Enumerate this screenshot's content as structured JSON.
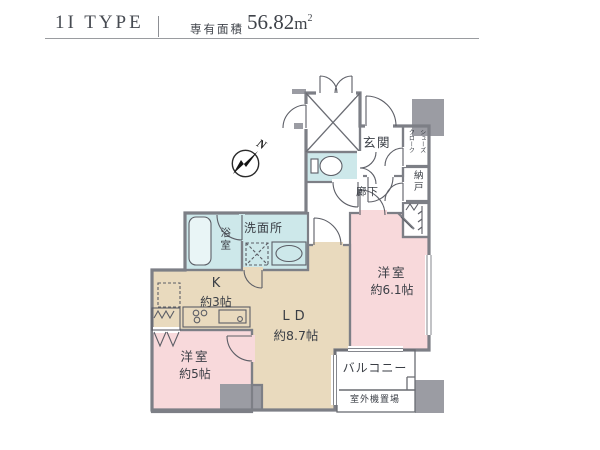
{
  "header": {
    "type_name": "1I TYPE",
    "area_label": "専有面積",
    "area_value": "56.82",
    "area_unit": "m",
    "area_unit_exp": "2"
  },
  "compass": {
    "north": "N"
  },
  "rooms": {
    "entrance": {
      "label": "玄関"
    },
    "shoe_closet": {
      "label": "シューズ\nクローク"
    },
    "storage": {
      "label": "納戸"
    },
    "hallway": {
      "label": "廊下"
    },
    "bathroom": {
      "label": "浴室"
    },
    "washroom": {
      "label": "洗面所"
    },
    "kitchen": {
      "label": "K",
      "size": "約3帖"
    },
    "living_dining": {
      "label": "LD",
      "size": "約8.7帖"
    },
    "bedroom_right": {
      "label": "洋室",
      "size": "約6.1帖"
    },
    "bedroom_left": {
      "label": "洋室",
      "size": "約5帖"
    },
    "balcony": {
      "label": "バルコニー"
    },
    "outdoor_unit": {
      "label": "室外機置場"
    }
  },
  "colors": {
    "bedroom_pink": "#f8d9db",
    "living_tan": "#e9dabe",
    "wet_area_blue": "#cde8ea",
    "common_gray": "#9b9ca3",
    "wall_gray": "#7d7f86"
  }
}
